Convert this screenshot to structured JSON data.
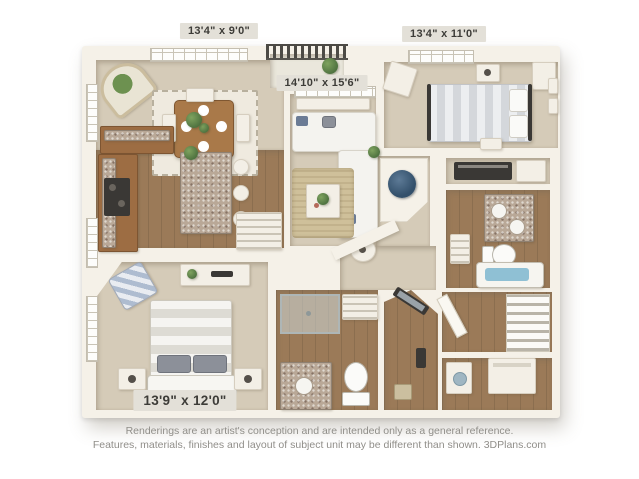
{
  "plan": {
    "rooms": {
      "dining": {
        "name": "dining-room",
        "label": "13'4\" x 9'0\""
      },
      "living": {
        "name": "living-room",
        "label": "14'10\" x 15'6\""
      },
      "bedroom2": {
        "name": "bedroom-top-right",
        "label": "13'4\" x 11'0\""
      },
      "bedroom1": {
        "name": "bedroom-bottom-left",
        "label": "13'9\" x 12'0\""
      }
    }
  },
  "caption": {
    "line1": "Renderings are an artist's conception and are intended only as a general reference.",
    "line2": "Features, materials, finishes and layout of subject unit may be different than shown. 3DPlans.com"
  },
  "colors": {
    "wall": "#f5f1e8",
    "carpet": "#d5cbb8",
    "wood": "#9b7a58",
    "chip-bg": "#e3e0d8",
    "chip-text": "#3d3c38",
    "caption": "#908e89",
    "water": "#8fc0d4",
    "heater-navy": "#33506b"
  }
}
